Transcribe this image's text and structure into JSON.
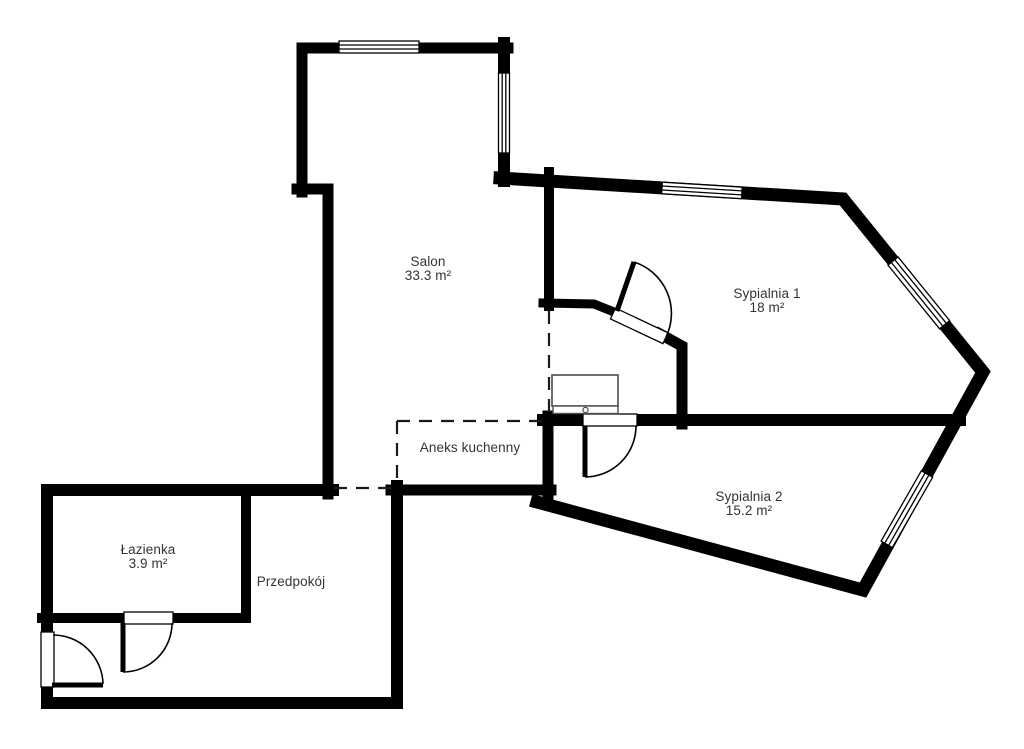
{
  "palette": {
    "background": "#ffffff",
    "walls": "#000000",
    "text": "#343434",
    "furniture_outline": "#4d4d4d"
  },
  "rooms": [
    {
      "id": "salon",
      "name": "Salon",
      "area": "33.3 m²"
    },
    {
      "id": "sypialnia1",
      "name": "Sypialnia 1",
      "area": "18 m²"
    },
    {
      "id": "sypialnia2",
      "name": "Sypialnia 2",
      "area": "15.2 m²"
    },
    {
      "id": "aneks",
      "name": "Aneks kuchenny",
      "area": ""
    },
    {
      "id": "lazienka",
      "name": "Łazienka",
      "area": "3.9 m²"
    },
    {
      "id": "przedpokoj",
      "name": "Przedpokój",
      "area": ""
    }
  ],
  "symbols": {
    "windows": [
      "salon-top-window",
      "salon-right-window",
      "sypialnia1-top-window",
      "sypialnia1-diagonal-window",
      "sypialnia2-diagonal-window"
    ],
    "doors": [
      "entry-door",
      "lazienka-door",
      "sypialnia1-door",
      "sypialnia2-door"
    ],
    "furniture": [
      "tv-unit"
    ]
  }
}
